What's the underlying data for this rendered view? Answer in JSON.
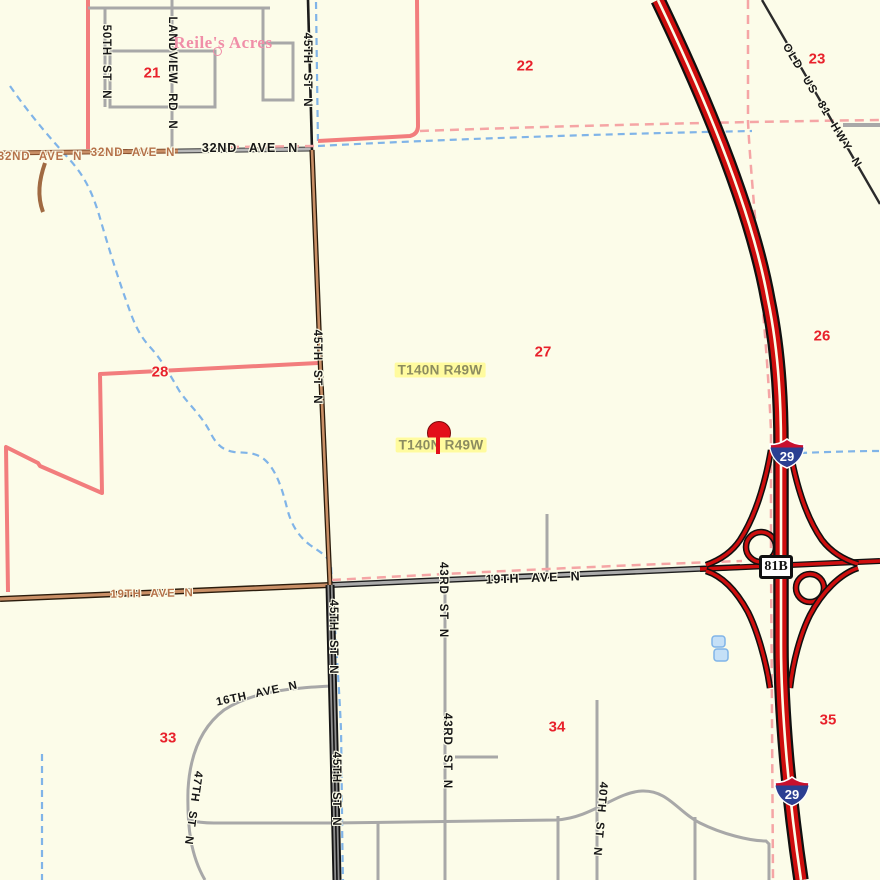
{
  "map": {
    "town": {
      "name": "Reile's Acres"
    },
    "township": {
      "label": "T140N R49W"
    },
    "sections": [
      "21",
      "22",
      "23",
      "26",
      "27",
      "28",
      "33",
      "34",
      "35"
    ],
    "streets": {
      "st50": "50TH ST N",
      "landview": "LANDVIEW RD N",
      "st45": "45TH ST N",
      "ave32": "32ND AVE N",
      "old81": "OLD US 81 HWY N",
      "ave19": "19TH AVE N",
      "st43": "43RD ST N",
      "ave16": "16TH AVE N",
      "st47": "47TH ST N",
      "st40": "40TH ST N"
    },
    "shields": {
      "interstate": "29",
      "business": "81B"
    },
    "colors": {
      "background": "#FCFCE9",
      "interstate_red": "#CE0E0E",
      "interstate_shield_blue": "#2B3F92",
      "interstate_shield_red": "#C8102E",
      "local_road_gray": "#A8A8A8",
      "boundary_pink_solid": "#F27D7D",
      "boundary_pink_dash": "#F5A5A5",
      "water_blue": "#80B4E8",
      "section_number_red": "#E8212B",
      "town_name_pink": "#F08EA8",
      "township_text_olive": "#8C8C60",
      "township_highlight_yellow": "#FFFB9E",
      "road_tan": "#C98F66",
      "marker_red": "#E3101A"
    }
  }
}
